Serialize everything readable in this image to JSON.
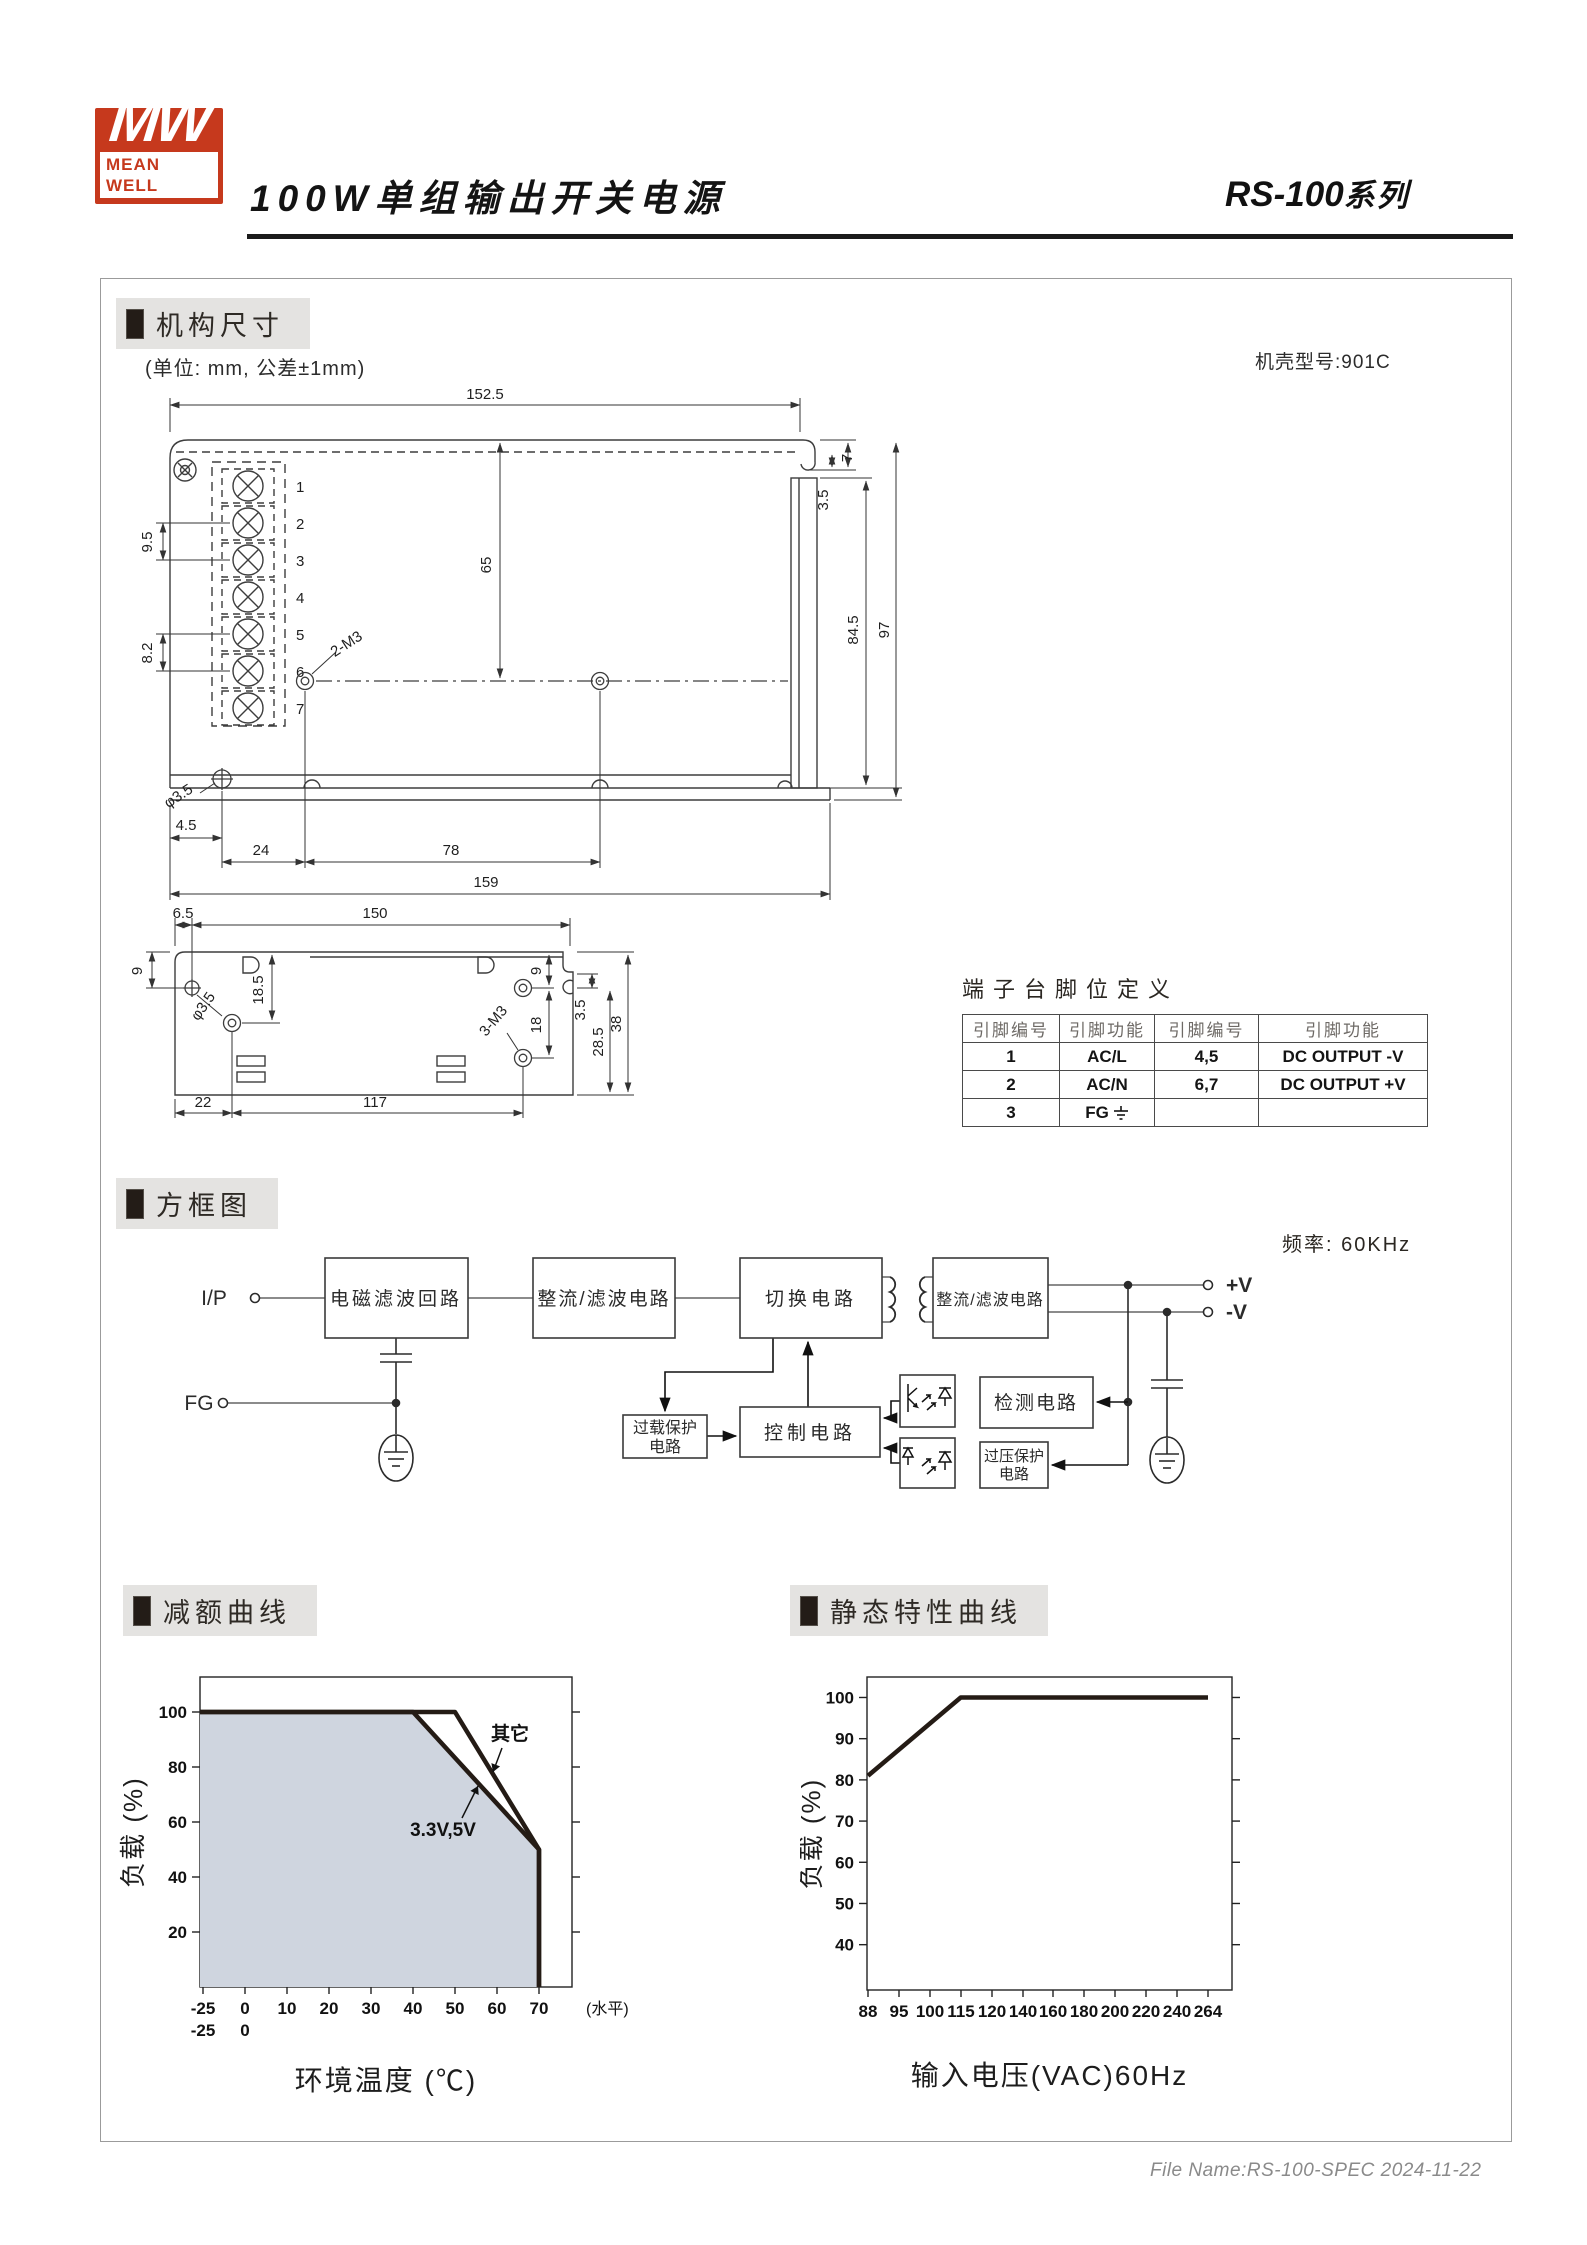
{
  "header": {
    "logo_monogram": "MW",
    "logo_name": "MEAN WELL",
    "title": "100W单组输出开关电源",
    "series": "RS-100",
    "series_suffix": "系列"
  },
  "sections": {
    "mechanical": "机构尺寸",
    "block": "方框图",
    "derating": "减额曲线",
    "static": "静态特性曲线"
  },
  "mechanical": {
    "unit_note": "(单位: mm, 公差±1mm)",
    "case_model": "机壳型号:901C",
    "pin_numbers": [
      "1",
      "2",
      "3",
      "4",
      "5",
      "6",
      "7"
    ],
    "front": {
      "w": "152.5",
      "top_gap": "7",
      "top_gap2": "3.5",
      "hole_span": "65",
      "h_right_inner": "84.5",
      "h_right_outer": "97",
      "pin_pitch": "9.5",
      "pin_pitch2": "8.2",
      "screw_callout": "2-M3",
      "hole_dia": "φ3.5",
      "base_offset": "4.5",
      "base_a": "24",
      "base_b": "78",
      "base_total": "159"
    },
    "bottom": {
      "offset": "6.5",
      "w": "150",
      "left_top": "9",
      "left_hole": "18.5",
      "hole_dia": "φ3.5",
      "screw_callout": "3-M3",
      "right_top": "9",
      "right_pitch": "18",
      "lip": "3.5",
      "right_lower": "28.5",
      "height": "38",
      "base_a": "22",
      "base_b": "117"
    }
  },
  "terminal_table": {
    "title": "端子台脚位定义",
    "headers": [
      "引脚编号",
      "引脚功能",
      "引脚编号",
      "引脚功能"
    ],
    "rows": [
      [
        "1",
        "AC/L",
        "4,5",
        "DC OUTPUT -V"
      ],
      [
        "2",
        "AC/N",
        "6,7",
        "DC OUTPUT +V"
      ],
      [
        "3",
        "FG",
        "",
        ""
      ]
    ]
  },
  "block_diagram": {
    "frequency": "频率: 60KHz",
    "io": {
      "input": "I/P",
      "fg": "FG",
      "v_plus": "+V",
      "v_minus": "-V"
    },
    "blocks": {
      "emi": "电磁滤波回路",
      "rectifier_in": "整流/滤波电路",
      "switching": "切换电路",
      "rectifier_out": "整流/滤波电路",
      "control": "控制电路",
      "detection": "检测电路",
      "overload_line1": "过载保护",
      "overload_line2": "电路",
      "ovp_line1": "过压保护",
      "ovp_line2": "电路"
    }
  },
  "chart_data": [
    {
      "type": "area",
      "title": "减额曲线",
      "xlabel": "环境温度 (℃)",
      "ylabel": "负载 (%)",
      "x_ticks": [
        "-25",
        "0",
        "10",
        "20",
        "30",
        "40",
        "50",
        "60",
        "70"
      ],
      "x_ticks_row2": [
        "-25",
        "0"
      ],
      "x_axis_suffix": "(水平)",
      "y_ticks": [
        20,
        40,
        60,
        80,
        100
      ],
      "ylim": [
        0,
        112
      ],
      "grid": false,
      "fill_color": "#cfd5df",
      "series": [
        {
          "name": "其它",
          "points": [
            [
              -25,
              100
            ],
            [
              50,
              100
            ],
            [
              70,
              50
            ],
            [
              70,
              0
            ]
          ],
          "filled": false
        },
        {
          "name": "3.3V,5V",
          "points": [
            [
              -25,
              100
            ],
            [
              40,
              100
            ],
            [
              70,
              50
            ],
            [
              70,
              0
            ]
          ],
          "filled": true
        }
      ]
    },
    {
      "type": "line",
      "title": "静态特性曲线",
      "xlabel": "输入电压(VAC)60Hz",
      "ylabel": "负载 (%)",
      "x_ticks": [
        "88",
        "95",
        "100",
        "115",
        "120",
        "140",
        "160",
        "180",
        "200",
        "220",
        "240",
        "264"
      ],
      "y_ticks": [
        40,
        50,
        60,
        70,
        80,
        90,
        100
      ],
      "ylim": [
        29,
        105
      ],
      "grid": false,
      "series": [
        {
          "name": "load",
          "points": [
            [
              88,
              81
            ],
            [
              115,
              100
            ],
            [
              264,
              100
            ]
          ],
          "filled": false
        }
      ]
    }
  ],
  "footer": {
    "file_name": "File Name:RS-100-SPEC  2024-11-22"
  }
}
